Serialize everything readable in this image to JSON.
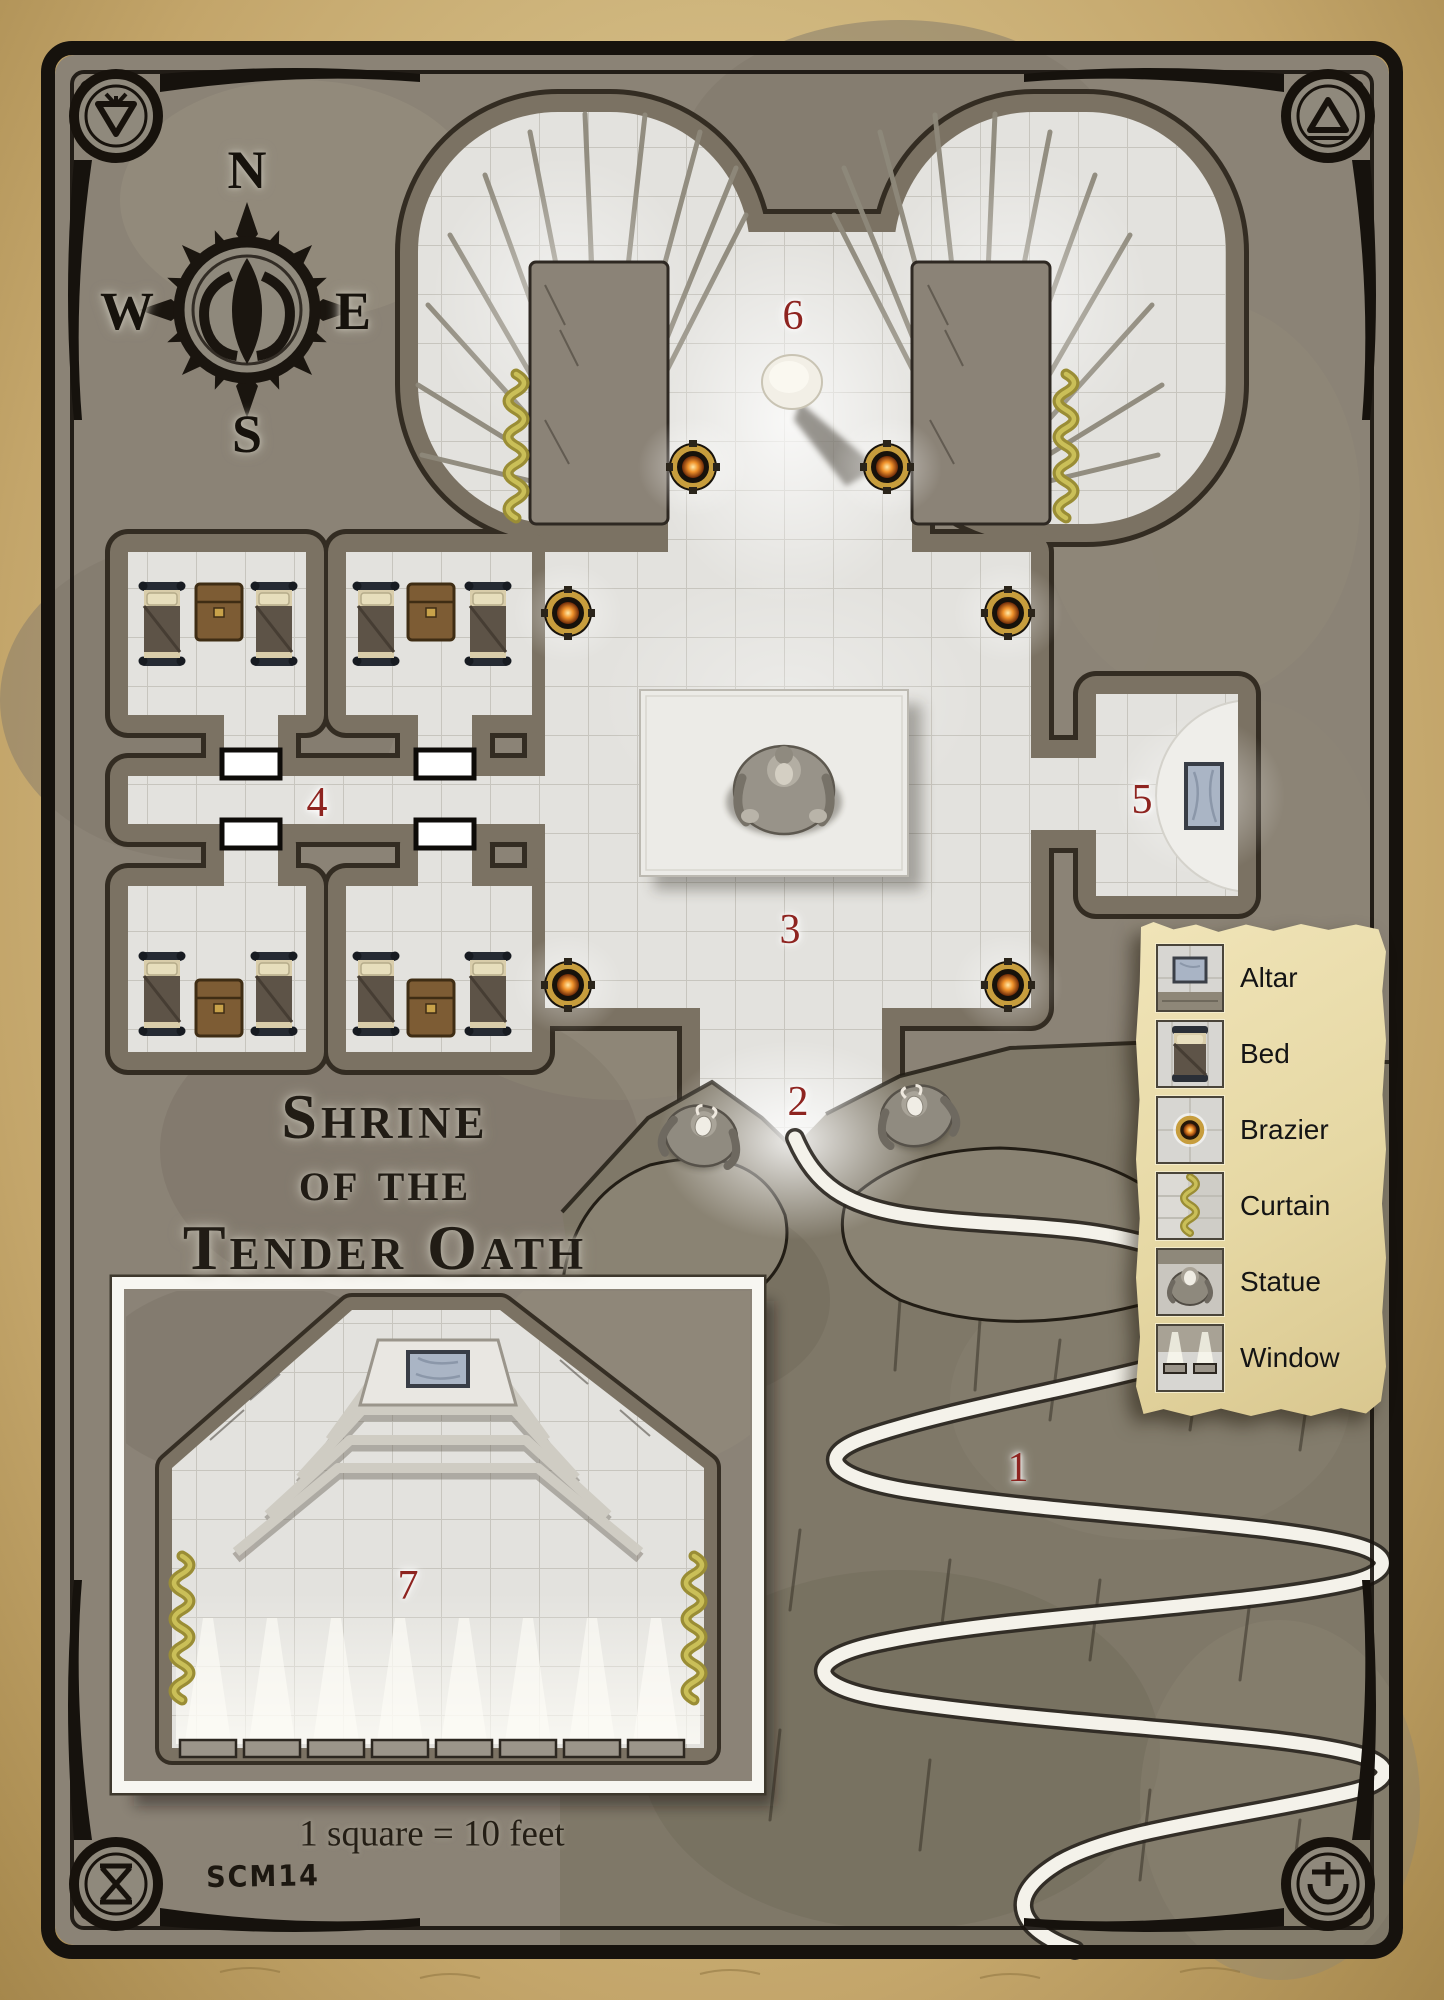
{
  "title": {
    "line1": "Shrine",
    "line2": "of the",
    "line3": "Tender Oath",
    "full": "Shrine of the Tender Oath"
  },
  "compass": {
    "north": "N",
    "east": "E",
    "south": "S",
    "west": "W"
  },
  "map_notes": {
    "scale": "1 square = 10 feet",
    "signature": "SCM14"
  },
  "room_labels": [
    {
      "number": "1"
    },
    {
      "number": "2"
    },
    {
      "number": "3"
    },
    {
      "number": "4"
    },
    {
      "number": "5"
    },
    {
      "number": "6"
    },
    {
      "number": "7"
    }
  ],
  "legend": {
    "items": [
      {
        "label": "Altar",
        "icon": "altar-icon"
      },
      {
        "label": "Bed",
        "icon": "bed-icon"
      },
      {
        "label": "Brazier",
        "icon": "brazier-icon"
      },
      {
        "label": "Curtain",
        "icon": "curtain-icon"
      },
      {
        "label": "Statue",
        "icon": "statue-icon"
      },
      {
        "label": "Window",
        "icon": "window-icon"
      }
    ]
  },
  "colors": {
    "parchment": "#d2ba82",
    "legend_parchment": "#e6d8a4",
    "stone": "#8b8376",
    "floor": "#e3e2de",
    "wall": "#7b7263",
    "ink": "#16120d",
    "label_red": "#8e2420",
    "curtain_gold": "#9a8d35",
    "brazier_gold": "#c79d3d",
    "altar_blue": "#aab5c5"
  }
}
